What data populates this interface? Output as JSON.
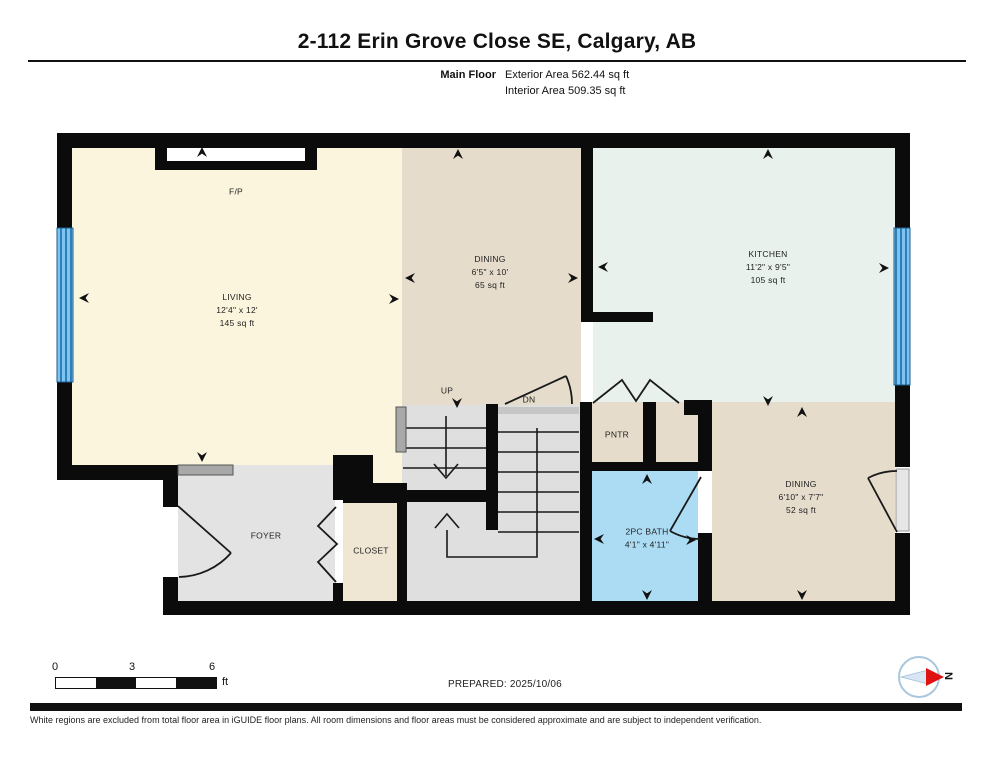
{
  "header": {
    "title": "2-112 Erin Grove Close SE, Calgary, AB",
    "floor_label": "Main Floor",
    "exterior_area": "Exterior Area 562.44 sq ft",
    "interior_area": "Interior Area 509.35 sq ft"
  },
  "rooms": {
    "living": {
      "name": "LIVING",
      "dims": "12'4\" x 12'",
      "area": "145 sq ft"
    },
    "dining_main": {
      "name": "DINING",
      "dims": "6'5\" x 10'",
      "area": "65 sq ft"
    },
    "kitchen": {
      "name": "KITCHEN",
      "dims": "11'2\" x 9'5\"",
      "area": "105 sq ft"
    },
    "dining_nook": {
      "name": "DINING",
      "dims": "6'10\" x 7'7\"",
      "area": "52 sq ft"
    },
    "bath": {
      "name": "2PC BATH",
      "dims": "4'1\" x 4'11\""
    },
    "foyer": {
      "name": "FOYER"
    },
    "closet": {
      "name": "CLOSET"
    },
    "pantry": {
      "name": "PNTR"
    },
    "fireplace": {
      "name": "F/P"
    },
    "stairs_up": {
      "name": "UP"
    },
    "stairs_down": {
      "name": "DN"
    }
  },
  "footer": {
    "scale": {
      "tick0": "0",
      "tick1": "3",
      "tick2": "6",
      "unit": "ft"
    },
    "prepared": "PREPARED: 2025/10/06",
    "compass_label": "N",
    "disclaimer": "White regions are excluded from total floor area in iGUIDE floor plans. All room dimensions and floor areas must be considered approximate and are subject to independent verification."
  },
  "colors": {
    "wall": "#0b0b0b",
    "living_floor": "#fbf5de",
    "dining_floor": "#e5dccc",
    "kitchen_floor": "#e8f1eb",
    "bath_floor": "#acdcf4",
    "foyer_floor": "#e3e3e3",
    "closet_floor": "#f0e6d4",
    "stairs_floor": "#dfdfdf",
    "window_blue": "#7fc3ef",
    "compass_red": "#e01111"
  }
}
